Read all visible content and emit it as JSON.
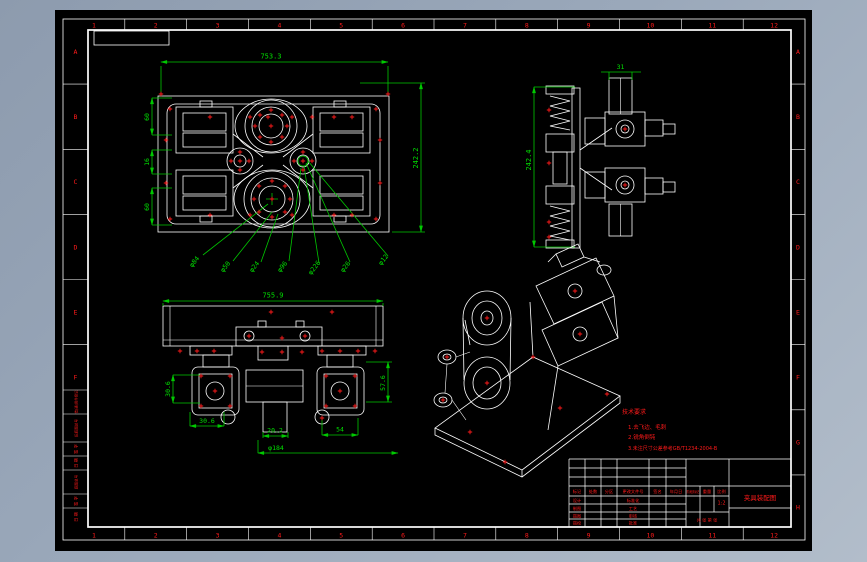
{
  "zones": {
    "top": [
      "1",
      "2",
      "3",
      "4",
      "5",
      "6",
      "7",
      "8",
      "9",
      "10",
      "11",
      "12"
    ],
    "bottom": [
      "1",
      "2",
      "3",
      "4",
      "5",
      "6",
      "7",
      "8",
      "9",
      "10",
      "11",
      "12"
    ],
    "left": [
      "A",
      "B",
      "C",
      "D",
      "E",
      "F"
    ],
    "right": [
      "A",
      "B",
      "C",
      "D",
      "E",
      "F",
      "G",
      "H"
    ]
  },
  "margin_block": {
    "cells": [
      "借(通)用件登记",
      "旧底图总号",
      "签 字",
      "日 期",
      "底图总号",
      "签 字",
      "日 期"
    ]
  },
  "views": {
    "plan": {
      "dims": {
        "width": "753.3",
        "height": "242.2",
        "left": [
          "60",
          "16",
          "60"
        ]
      },
      "leaders": [
        "φ84",
        "φ50",
        "φ24",
        "φ96",
        "φ226",
        "φ26",
        "φ12"
      ]
    },
    "side": {
      "dims": {
        "height": "242.4",
        "width": "31"
      }
    },
    "front": {
      "dims": {
        "width": "755.9",
        "left": "30.6",
        "bottom": "30.6",
        "center": "20.2",
        "dia": "φ184",
        "right": "54",
        "side": "57.6"
      }
    }
  },
  "notes": {
    "title": "技术要求",
    "items": [
      "1.去飞边、毛刺",
      "2.锐角倒钝",
      "3.未注尺寸公差参考GB/T1234-2004-B"
    ]
  },
  "title_block": {
    "revision_headers": [
      "标记",
      "处数",
      "分区",
      "更改文件号",
      "签名",
      "年月日"
    ],
    "sign_left": [
      "设计",
      "制图",
      "描图",
      "描校"
    ],
    "sign_right": [
      "标准化",
      "工艺",
      "审核",
      "批准"
    ],
    "stage_label": "阶段标记",
    "weight_label": "重量",
    "scale_label": "比例",
    "scale_value": "1:2",
    "sheet_info": "共 张 第 张",
    "drawing_name": "夹具装配图"
  },
  "colors": {
    "background": "#9aa8ba",
    "paper": "#000000",
    "lines": "#ffffff",
    "dimensions": "#00c800",
    "annotations": "#ff1a1a"
  }
}
